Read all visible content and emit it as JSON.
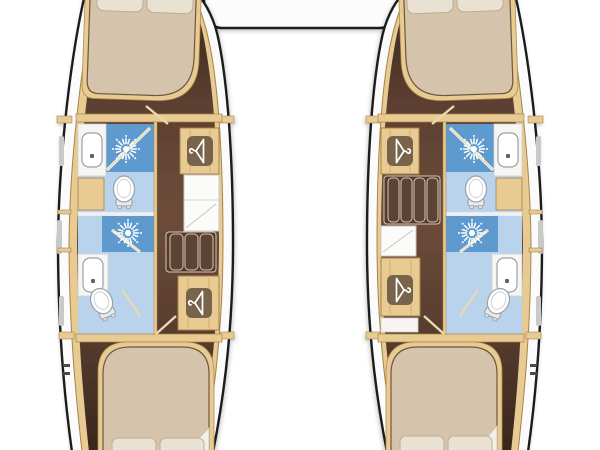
{
  "diagram": {
    "kind": "catamaran-interior-floor-plan",
    "hull_count": 2,
    "visible_text": ""
  },
  "palette": {
    "hull_outline": "#1c1c1c",
    "deck_white": "#fbfbfb",
    "wall_tan": "#e7cb92",
    "wall_tan_border": "#a8834b",
    "wall_grain": "#d3ae67",
    "floor_brown_dark": "#38261d",
    "floor_brown": "#5a3e2f",
    "floor_brown_light": "#6d4c3a",
    "bed_beige": "#d5c4ab",
    "bed_border": "#6e563e",
    "pillow": "#e9e1d1",
    "pillow_border": "#bdae94",
    "shower_blue": "#5e9ace",
    "bath_floor_blue": "#bad3ec",
    "fixture_white": "#ffffff",
    "fixture_border": "#9aa0a6",
    "counter_white": "#f6f5f2",
    "counter_border": "#cfcfcf",
    "wardrobe_tile": "#6f5a45",
    "icon_white": "#ffffff",
    "stair_brown": "#54392c",
    "stair_slat": "#5d4334",
    "stair_edge": "#d6c9b6",
    "window_gray": "#c9c9c9",
    "glass_line": "#ead9ae",
    "shadow_gray": "#cdcdcd"
  },
  "icons": {
    "shower_head": "shower-head-icon (sunburst spray)",
    "hanger": "hanger-icon (clothes hanger in wardrobe)",
    "toilet": "toilet-icon (top view bowl with tank)",
    "sink": "sink-icon (basin with drain dot)"
  },
  "overhead": {
    "element": "cockpit-connector-pod"
  },
  "hulls": [
    {
      "id": "port-hull",
      "side": "left",
      "rooms": [
        {
          "name": "forward-cabin",
          "fixtures": [
            "double-bed",
            "pillows"
          ]
        },
        {
          "name": "forward-bathroom",
          "fixtures": [
            "shower",
            "sink",
            "toilet"
          ]
        },
        {
          "name": "aft-bathroom",
          "fixtures": [
            "shower",
            "sink",
            "toilet"
          ]
        },
        {
          "name": "companionway",
          "fixtures": [
            "stairs-3-steps",
            "wardrobe",
            "vanity-shelves",
            "wardrobe"
          ]
        },
        {
          "name": "aft-cabin",
          "fixtures": [
            "double-bed",
            "pillows"
          ]
        }
      ]
    },
    {
      "id": "starboard-hull",
      "side": "right",
      "rooms": [
        {
          "name": "forward-cabin",
          "fixtures": [
            "double-bed",
            "pillows"
          ]
        },
        {
          "name": "forward-bathroom",
          "fixtures": [
            "shower",
            "sink",
            "toilet"
          ]
        },
        {
          "name": "aft-bathroom",
          "fixtures": [
            "shower",
            "sink",
            "toilet"
          ]
        },
        {
          "name": "companionway",
          "fixtures": [
            "wardrobe",
            "stairs-4-steps",
            "vanity-shelves",
            "wardrobe"
          ]
        },
        {
          "name": "aft-cabin",
          "fixtures": [
            "double-bed",
            "pillows"
          ]
        }
      ]
    }
  ]
}
